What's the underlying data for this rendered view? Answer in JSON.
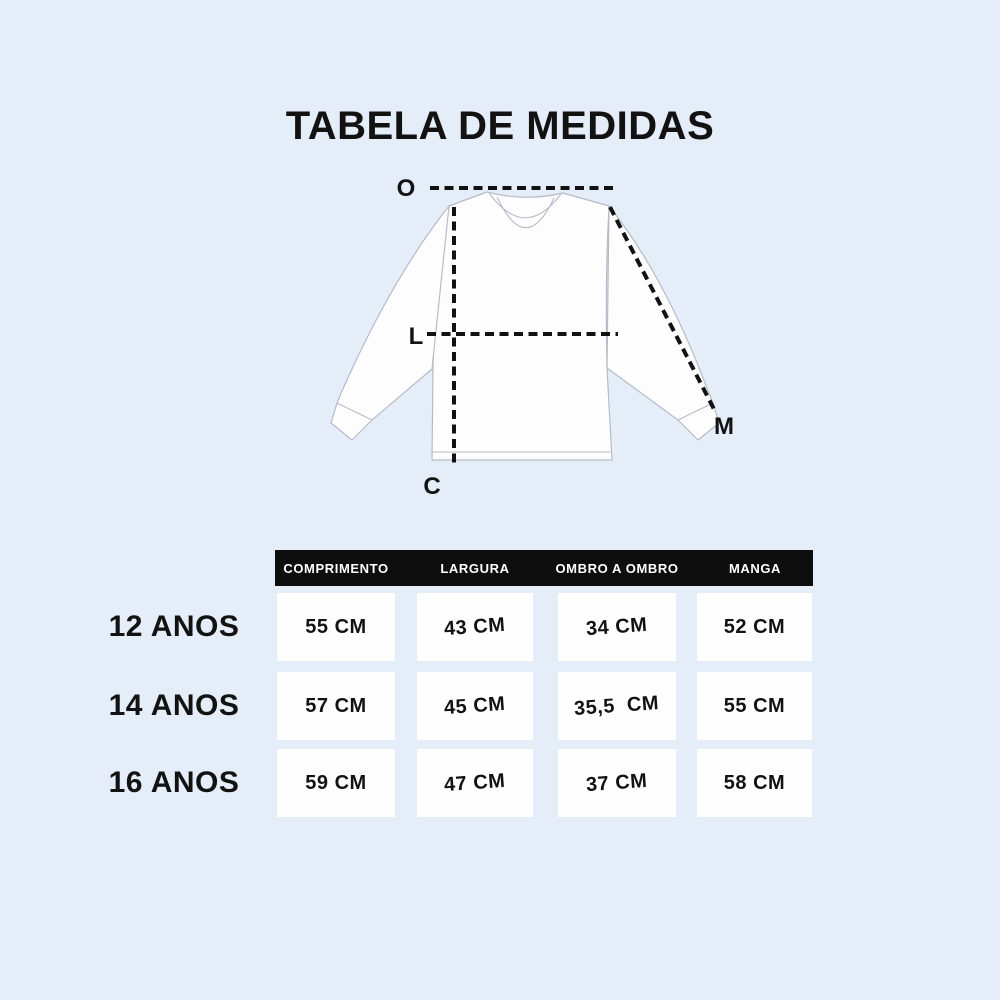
{
  "title": "TABELA DE MEDIDAS",
  "colors": {
    "bg": "#e4edf8",
    "ink": "#121212",
    "header_bg": "#0e0e0e",
    "header_fg": "#ffffff",
    "cell_bg": "#fefefe",
    "shirt_fill": "#fdfdfe",
    "outline": "#b5bcc8"
  },
  "diagram": {
    "shoulder_label": "O",
    "width_label": "L",
    "length_label": "C",
    "sleeve_label": "M"
  },
  "table": {
    "columns": [
      "COMPRIMENTO",
      "LARGURA",
      "OMBRO A OMBRO",
      "MANGA"
    ],
    "rows": [
      {
        "label": "12 ANOS",
        "values": [
          "55 CM",
          "43 CM",
          "34 CM",
          "52 CM"
        ]
      },
      {
        "label": "14 ANOS",
        "values": [
          "57 CM",
          "45 CM",
          "35,5  CM",
          "55 CM"
        ]
      },
      {
        "label": "16 ANOS",
        "values": [
          "59 CM",
          "47 CM",
          "37 CM",
          "58 CM"
        ]
      }
    ]
  },
  "chart_data": {
    "type": "table",
    "title": "TABELA DE MEDIDAS",
    "columns": [
      "COMPRIMENTO",
      "LARGURA",
      "OMBRO A OMBRO",
      "MANGA"
    ],
    "row_labels": [
      "12 ANOS",
      "14 ANOS",
      "16 ANOS"
    ],
    "rows": [
      [
        "55 CM",
        "43 CM",
        "34 CM",
        "52 CM"
      ],
      [
        "57 CM",
        "45 CM",
        "35,5 CM",
        "55 CM"
      ],
      [
        "59 CM",
        "47 CM",
        "37 CM",
        "58 CM"
      ]
    ],
    "diagram_labels": [
      "O",
      "L",
      "C",
      "M"
    ]
  }
}
